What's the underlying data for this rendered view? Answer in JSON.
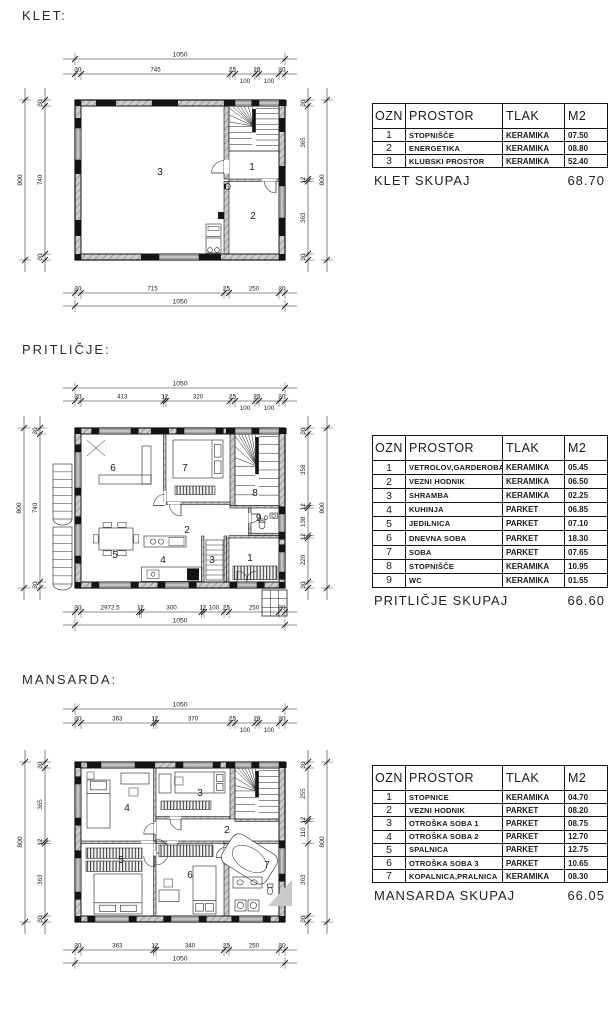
{
  "doc": {
    "floors": [
      {
        "title": "KLET:",
        "rooms": [
          "3",
          "1",
          "2"
        ],
        "dims": {
          "top_total": "1050",
          "top_chain": [
            "30",
            "745",
            "25",
            "100",
            "20",
            "100",
            "30"
          ],
          "bottom_chain": [
            "30",
            "715",
            "25",
            "250",
            "30"
          ],
          "bottom_total": "1050",
          "left_chain": [
            "30",
            "740",
            "30"
          ],
          "left_total": "800",
          "right_chain": [
            "30",
            "365",
            "12",
            "363",
            "30"
          ],
          "right_total": "800"
        },
        "table": {
          "headers": [
            "OZN",
            "PROSTOR",
            "TLAK",
            "M2"
          ],
          "rows": [
            [
              "1",
              "STOPNIŠČE",
              "KERAMIKA",
              "07.50"
            ],
            [
              "2",
              "ENERGETIKA",
              "KERAMIKA",
              "08.80"
            ],
            [
              "3",
              "KLUBSKI PROSTOR",
              "KERAMIKA",
              "52.40"
            ]
          ],
          "total_label": "KLET SKUPAJ",
          "total_value": "68.70"
        }
      },
      {
        "title": "PRITLIČJE:",
        "rooms": [
          "6",
          "7",
          "8",
          "2",
          "5",
          "4",
          "3",
          "1",
          "9"
        ],
        "dims": {
          "top_total": "1050",
          "top_chain": [
            "30",
            "413",
            "12",
            "320",
            "25",
            "100",
            "20",
            "100",
            "30"
          ],
          "bottom_chain": [
            "30",
            "2972.5",
            "12",
            "300",
            "12",
            "100",
            "25",
            "250",
            "30"
          ],
          "bottom_total": "1050",
          "left_chain": [
            "30",
            "740",
            "30"
          ],
          "left_total": "800",
          "right_chain": [
            "30",
            "358",
            "12",
            "138",
            "12",
            "220",
            "30"
          ],
          "right_total": "800"
        },
        "table": {
          "headers": [
            "OZN",
            "PROSTOR",
            "TLAK",
            "M2"
          ],
          "rows": [
            [
              "1",
              "VETROLOV,GARDEROBA",
              "KERAMIKA",
              "05.45"
            ],
            [
              "2",
              "VEZNI HODNIK",
              "KERAMIKA",
              "06.50"
            ],
            [
              "3",
              "SHRAMBA",
              "KERAMIKA",
              "02.25"
            ],
            [
              "4",
              "KUHINJA",
              "PARKET",
              "06.85"
            ],
            [
              "5",
              "JEDILNICA",
              "PARKET",
              "07.10"
            ],
            [
              "6",
              "DNEVNA SOBA",
              "PARKET",
              "18.30"
            ],
            [
              "7",
              "SOBA",
              "PARKET",
              "07.65"
            ],
            [
              "8",
              "STOPNIŠČE",
              "KERAMIKA",
              "10.95"
            ],
            [
              "9",
              "WC",
              "KERAMIKA",
              "01.55"
            ]
          ],
          "total_label": "PRITLIČJE SKUPAJ",
          "total_value": "66.60"
        }
      },
      {
        "title": "MANSARDA:",
        "rooms": [
          "4",
          "3",
          "2",
          "5",
          "6",
          "7"
        ],
        "dims": {
          "top_total": "1050",
          "top_chain": [
            "30",
            "363",
            "12",
            "370",
            "25",
            "100",
            "20",
            "100",
            "30"
          ],
          "bottom_chain": [
            "30",
            "363",
            "12",
            "340",
            "25",
            "250",
            "30"
          ],
          "bottom_total": "1050",
          "left_chain": [
            "30",
            "365",
            "12",
            "363",
            "30"
          ],
          "left_total": "800",
          "right_chain": [
            "30",
            "255",
            "12",
            "110",
            "363",
            "30"
          ],
          "right_total": "800"
        },
        "table": {
          "headers": [
            "OZN",
            "PROSTOR",
            "TLAK",
            "M2"
          ],
          "rows": [
            [
              "1",
              "STOPNICE",
              "KERAMIKA",
              "04.70"
            ],
            [
              "2",
              "VEZNI HODNIK",
              "PARKET",
              "08.20"
            ],
            [
              "3",
              "OTROŠKA SOBA 1",
              "PARKET",
              "08.75"
            ],
            [
              "4",
              "OTROŠKA SOBA 2",
              "PARKET",
              "12.70"
            ],
            [
              "5",
              "SPALNICA",
              "PARKET",
              "12.75"
            ],
            [
              "6",
              "OTROŠKA SOBA 3",
              "PARKET",
              "10.65"
            ],
            [
              "7",
              "KOPALNICA,PRALNICA",
              "KERAMIKA",
              "08.30"
            ]
          ],
          "total_label": "MANSARDA SKUPAJ",
          "total_value": "66.05"
        }
      }
    ]
  }
}
